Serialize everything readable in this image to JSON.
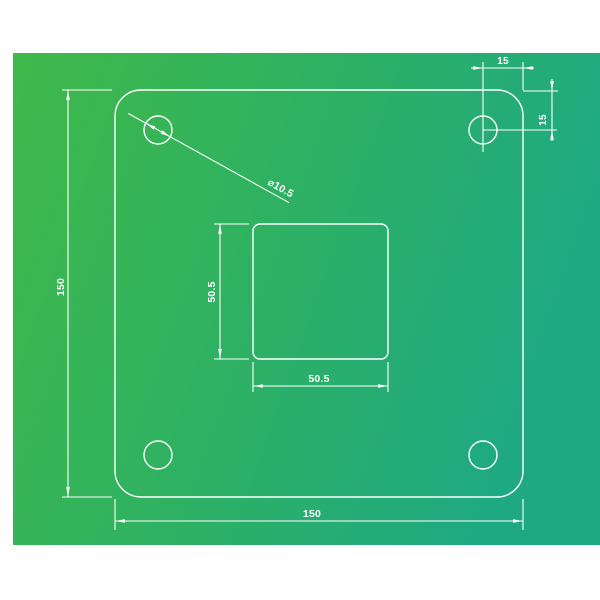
{
  "drawing": {
    "kind": "technical-drawing",
    "part": "square mounting plate with rounded corners, four corner holes and square center cutout"
  },
  "labels": {
    "plate_height": "150",
    "plate_width": "150",
    "cutout_height": "50.5",
    "cutout_width": "50.5",
    "hole_offset_top": "15",
    "hole_offset_side": "15",
    "hole_diameter": "⌀10.5"
  },
  "colors": {
    "line": "#ffffff",
    "text": "#ffffff",
    "bg_gradient_start": "#40b94a",
    "bg_gradient_mid": "#2eb162",
    "bg_gradient_end": "#1fa982",
    "page_background": "#ffffff"
  }
}
